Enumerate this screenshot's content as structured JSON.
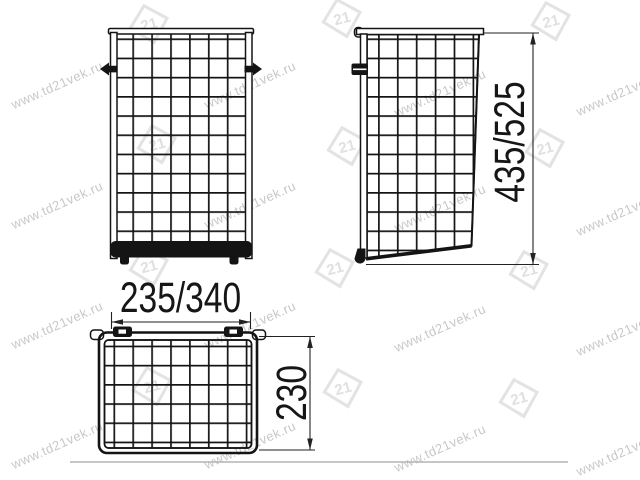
{
  "dimensions": {
    "width": "235/340",
    "height": "435/525",
    "depth": "230"
  },
  "watermark": {
    "url": "www.td21vek.ru",
    "logo": "21"
  },
  "colors": {
    "ink": "#141414",
    "dimension": "#222222",
    "watermark_text": "#c8c8c8",
    "watermark_logo": "#e3e3e3",
    "baseline_rule": "#b4b4b4",
    "background": "#ffffff"
  }
}
